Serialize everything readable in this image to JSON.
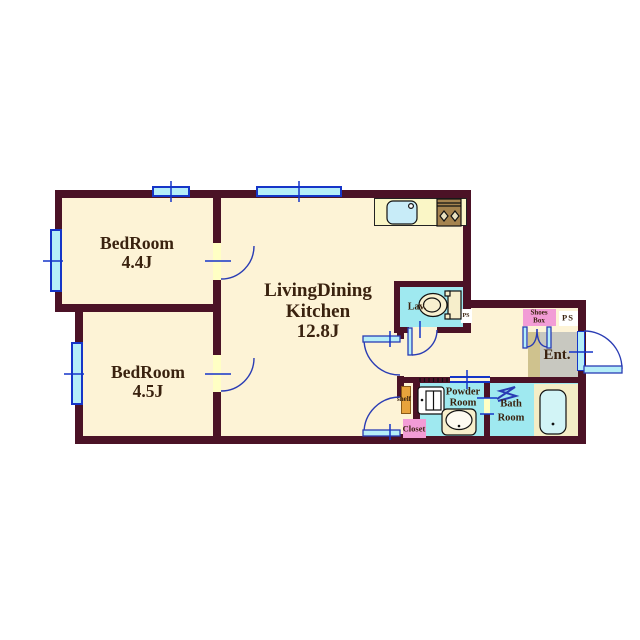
{
  "plan_title": "apartment-floor-plan",
  "labels": {
    "bedroom1": {
      "name": "BedRoom",
      "size": "4.4J"
    },
    "bedroom2": {
      "name": "BedRoom",
      "size": "4.5J"
    },
    "ldk": {
      "line1": "LivingDining",
      "line2": "Kitchen",
      "size": "12.8J"
    },
    "lav": "Lav.",
    "ps_small": "PS",
    "shoes_box": {
      "line1": "Shoes",
      "line2": "Box"
    },
    "ps": "PS",
    "entrance": "Ent.",
    "powder": {
      "line1": "Powder",
      "line2": "Room"
    },
    "bath": {
      "line1": "Bath",
      "line2": "Room"
    },
    "closet": "Closet",
    "shelf": "shelf"
  },
  "fixtures": [
    "kitchen-sink",
    "gas-stove",
    "toilet",
    "washing-machine",
    "powder-sink",
    "bathtub",
    "shower-folding-door",
    "shoes-cabinet-doors",
    "entrance-door",
    "hinged-doors",
    "windows"
  ],
  "colors": {
    "wall": "#4b1226",
    "floor": "#fdf3d6",
    "wet_floor": "#9fe9f0",
    "window": "#1535c8",
    "window_fill": "#b5eef8",
    "arc": "#2a3cb4",
    "door_leaf": "#ffffc4",
    "entrance_floor": "#c8c8c0",
    "entrance_step": "#cfc28e",
    "label_pink": "#f29cd6",
    "shelf_orange": "#e8a33c",
    "counter": "#faf6c6",
    "stove": "#a5834f",
    "tub_surround": "#f4edc6",
    "fixture_cream": "#f6eecb",
    "text": "#3a220f"
  }
}
